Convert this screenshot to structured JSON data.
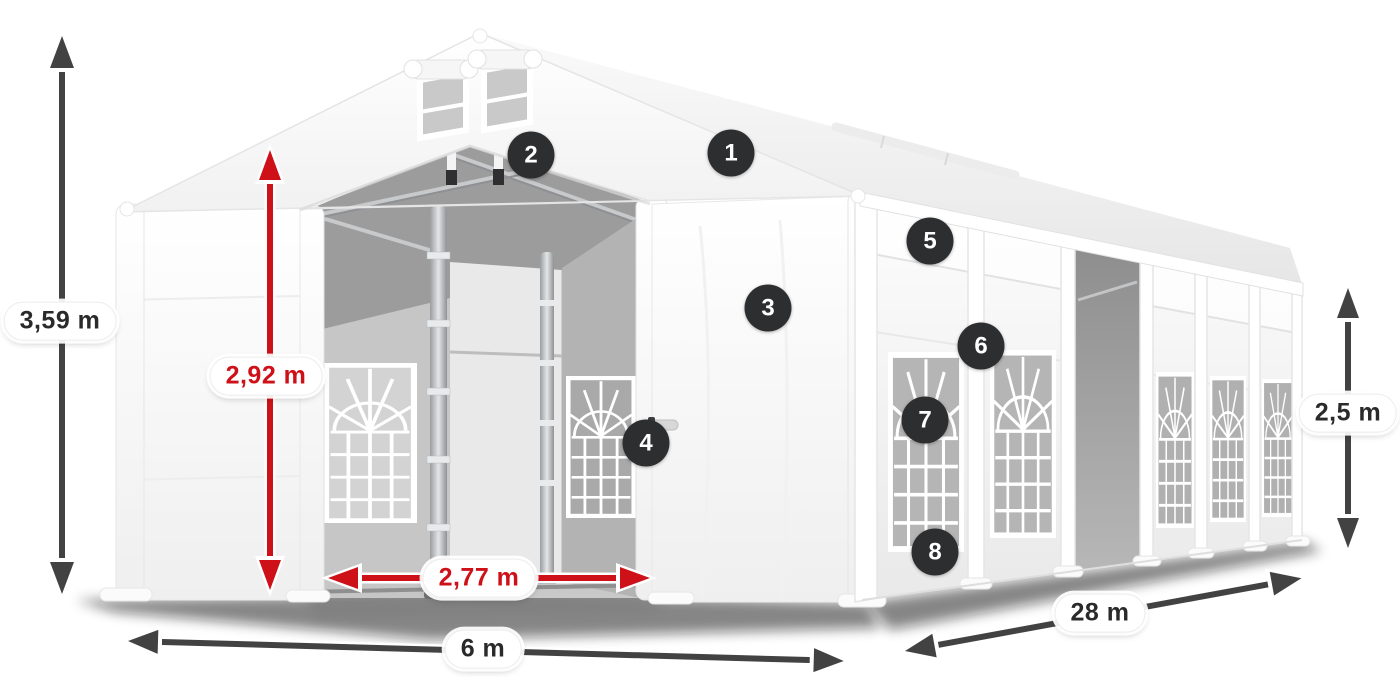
{
  "diagram": {
    "subject": "tent-dimension-diagram",
    "dimensions": {
      "total_height": "3,59 m",
      "entrance_height": "2,92 m",
      "entrance_width": "2,77 m",
      "front_width": "6 m",
      "side_length": "28 m",
      "side_height": "2,5 m"
    },
    "callouts": [
      "1",
      "2",
      "3",
      "4",
      "5",
      "6",
      "7",
      "8"
    ],
    "colors": {
      "dimension_red": "#ce1118",
      "arrow_dark": "#424242",
      "badge_background": "#2d2e30",
      "badge_text": "#ffffff",
      "label_text": "#2a2a2a"
    }
  }
}
